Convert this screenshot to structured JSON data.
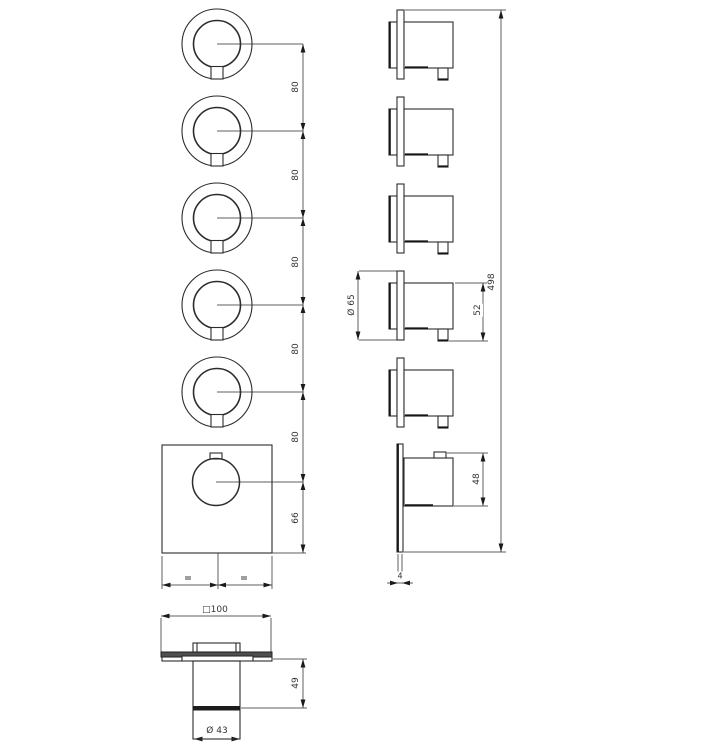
{
  "dims": {
    "front": {
      "knob_spacing": [
        "80",
        "80",
        "80",
        "80",
        "80"
      ],
      "bottom_offset": "66"
    },
    "side": {
      "total_height": "498",
      "knob_diameter": "Ø 65",
      "knob_depth": "52",
      "main_knob_depth": "48",
      "plate_thickness": "4"
    },
    "bottom": {
      "plate_width": "□100",
      "body_height": "49",
      "base_diameter": "Ø 43"
    }
  },
  "colors": {
    "background": "#ffffff",
    "object_line": "#2c2c2c",
    "dimension_line": "#5f5f5f",
    "arrow": "#1a1a1a",
    "text": "#333333",
    "plate_edge_fill": "#4f4f4f",
    "dark_band_fill": "#1c1c1c",
    "small_mark_fill": "#a0a0a0"
  }
}
